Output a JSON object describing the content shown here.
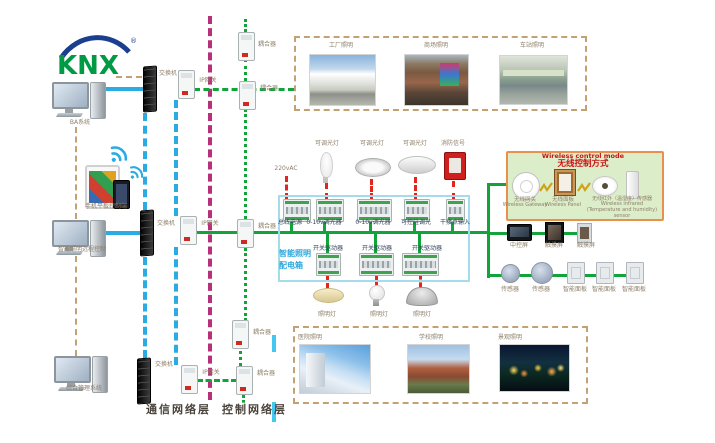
{
  "colors": {
    "bus_green": "#12a43b",
    "comm_blue": "#2aabe2",
    "layer_divider_magenta": "#b9307a",
    "power_red": "#e3261d",
    "frame_tan": "#c2a272",
    "cabinet_border_blue": "#a5dcec",
    "wireless_box_bg": "#dcedca",
    "wireless_box_border": "#e8914f",
    "knx_green": "#009a44",
    "knx_blue": "#1b3f8f"
  },
  "logo": {
    "text": "KNX",
    "registered": "®"
  },
  "left_column": {
    "pc1_label": "BA系统",
    "mobile_label": "手机平板控制端",
    "pc2_label": "智能照明远程控制",
    "pc3_label": "综合管理系统"
  },
  "network": {
    "row1": {
      "switch": "交换机",
      "gateway": "IP网关",
      "coupler_a": "耦合器",
      "coupler_b": "耦合器"
    },
    "row2": {
      "switch": "交换机",
      "gateway": "IP网关",
      "coupler": "耦合器"
    },
    "row3": {
      "switch": "交换机",
      "gateway": "IP网关",
      "coupler_a": "耦合器",
      "coupler_b": "耦合器"
    },
    "comm_layer_label": "通信网络层",
    "control_layer_label": "控制网络层"
  },
  "top_scenes": {
    "items": [
      {
        "label": "工厂照明"
      },
      {
        "label": "商场照明"
      },
      {
        "label": "车站照明"
      }
    ]
  },
  "bottom_scenes": {
    "items": [
      {
        "label": "医院照明"
      },
      {
        "label": "学校照明"
      },
      {
        "label": "景观照明"
      }
    ]
  },
  "cabinet": {
    "title_line1": "智能照明",
    "title_line2": "配电箱",
    "power_input": "220vAC",
    "top_loads": [
      {
        "label": "可调光灯"
      },
      {
        "label": "可调光灯"
      },
      {
        "label": "可调光灯"
      },
      {
        "label": "消防信号"
      }
    ],
    "row1_modules": [
      {
        "label": "总线电源"
      },
      {
        "label": "0-10v调光器"
      },
      {
        "label": "0-10v调光器"
      },
      {
        "label": "可控硅调光"
      },
      {
        "label": "干接点输入"
      }
    ],
    "row2_modules": [
      {
        "label": "开关驱动器"
      },
      {
        "label": "开关驱动器"
      },
      {
        "label": "开关驱动器"
      }
    ],
    "bottom_lamps": [
      {
        "label": "照明灯"
      },
      {
        "label": "照明灯"
      },
      {
        "label": "照明灯"
      }
    ]
  },
  "wireless": {
    "title_en": "Wireless control mode",
    "title_cn": "无线控制方式",
    "devices": [
      {
        "cn": "无线网关",
        "en": "Wireless Gateway"
      },
      {
        "cn": "无线面板",
        "en": "Wireless Panel"
      },
      {
        "cn": "无线红外（温湿度）传感器",
        "en": "Wireless infrared (Temperature and humidity) sensor"
      }
    ]
  },
  "control_devices": {
    "screens": [
      {
        "label": "中控屏"
      },
      {
        "label": "触摸屏"
      },
      {
        "label": "触摸屏"
      }
    ],
    "panels": [
      {
        "label": "传感器"
      },
      {
        "label": "传感器"
      },
      {
        "label": "智能面板"
      },
      {
        "label": "智能面板"
      },
      {
        "label": "智能面板"
      }
    ]
  }
}
